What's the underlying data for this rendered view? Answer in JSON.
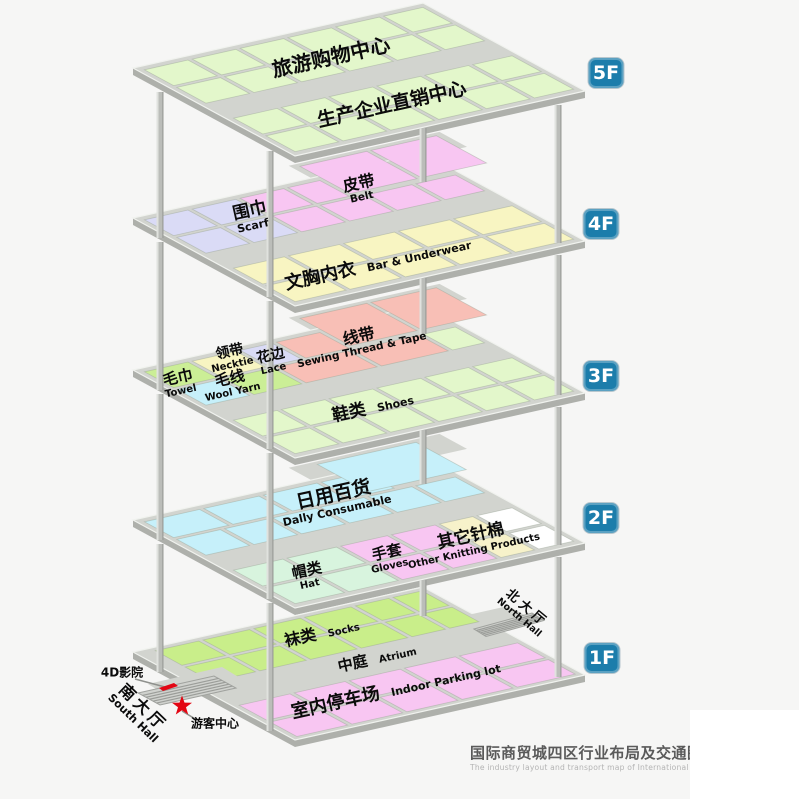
{
  "palette": {
    "bg": "#f6f6f5",
    "deck": "#d2d4cf",
    "deckSide": "#aeb0ab",
    "deckLine": "#f0f2ee",
    "ramp": "#d0d2ce",
    "hatch": "#9b9d99",
    "pillar": "#bbbdb9",
    "pillarHi": "#e0e2de",
    "pillarShade": "#9a9c98",
    "green": "#e3f7cb",
    "lavender": "#dadbf6",
    "pink": "#f8c6f2",
    "yellow": "#f8f5c2",
    "cyan": "#c6f0fa",
    "wool": "#cbee96",
    "salmon": "#f8bfb6",
    "mint": "#d8f4de",
    "paleyellow": "#f7f2ca",
    "white": "#ffffff",
    "sockgreen": "#c9ee8a",
    "pinkpark": "#f8c6f2",
    "badge": "#1c7dab",
    "red": "#e30613",
    "leader": "#8f918d",
    "title": "#5a5a5a",
    "subtitle": "#b4b4b4",
    "text": "#0b0b0b"
  },
  "floor_badges": [
    {
      "label": "5F"
    },
    {
      "label": "4F"
    },
    {
      "label": "3F"
    },
    {
      "label": "2F"
    },
    {
      "label": "1F"
    }
  ],
  "labels": {
    "f5_tourism": {
      "zh": "旅游购物中心"
    },
    "f5_direct": {
      "zh": "生产企业直销中心"
    },
    "f4_scarf": {
      "zh": "围巾",
      "en": "Scarf"
    },
    "f4_belt": {
      "zh": "皮带",
      "en": "Belt"
    },
    "f4_underwear": {
      "zh": "文胸内衣",
      "en": "Bar & Underwear"
    },
    "f3_thread": {
      "zh": "线带",
      "en": "Sewing Thread & Tape"
    },
    "f3_necktie": {
      "zh": "领带",
      "en": "Necktie"
    },
    "f3_lace": {
      "zh": "花边",
      "en": "Lace"
    },
    "f3_towel": {
      "zh": "毛巾",
      "en": "Towel"
    },
    "f3_wool": {
      "zh": "毛线",
      "en": "Wool Yarn"
    },
    "f3_shoes": {
      "zh": "鞋类",
      "en": "Shoes"
    },
    "f2_daily": {
      "zh": "日用百货",
      "en": "Dally Consumable"
    },
    "f2_hat": {
      "zh": "帽类",
      "en": "Hat"
    },
    "f2_gloves": {
      "zh": "手套",
      "en": "Gloves"
    },
    "f2_knitting": {
      "zh": "其它针棉",
      "en": "Other Knitting Products"
    },
    "f1_socks": {
      "zh": "袜类",
      "en": "Socks"
    },
    "f1_atrium": {
      "zh": "中庭",
      "en": "Atrium"
    },
    "f1_parking": {
      "zh": "室内停车场",
      "en": "Indoor Parking lot"
    },
    "north_hall": {
      "zh": "北大厅",
      "en": "North Hall"
    },
    "south_hall": {
      "zh": "南大厅",
      "en": "South Hall"
    },
    "cinema": {
      "zh": "4D影院"
    },
    "visitor": {
      "zh": "游客中心"
    }
  },
  "title": {
    "zh": "国际商贸城四区行业布局及交通图",
    "en": "The industry layout and transport map of International Trade Mart District Fo"
  }
}
